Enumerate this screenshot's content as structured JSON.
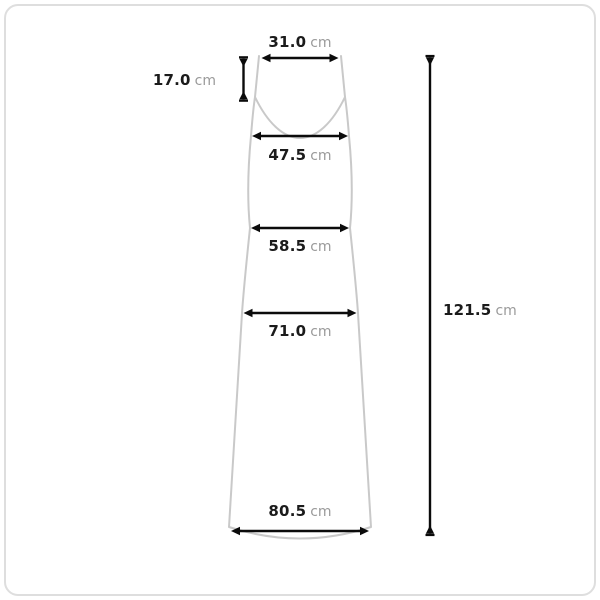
{
  "colors": {
    "background": "#ffffff",
    "frame_border": "#dedede",
    "dress_outline": "#c9c9c9",
    "dimension_line": "#0b0b0b",
    "value_text": "#1b1b1b",
    "unit_text": "#9a9a9a"
  },
  "measurements": {
    "top_width": {
      "value": "31.0",
      "unit": "cm"
    },
    "strap_length": {
      "value": "17.0",
      "unit": "cm"
    },
    "bust_width": {
      "value": "47.5",
      "unit": "cm"
    },
    "waist_width": {
      "value": "58.5",
      "unit": "cm"
    },
    "hip_width": {
      "value": "71.0",
      "unit": "cm"
    },
    "hem_width": {
      "value": "80.5",
      "unit": "cm"
    },
    "total_length": {
      "value": "121.5",
      "unit": "cm"
    }
  }
}
